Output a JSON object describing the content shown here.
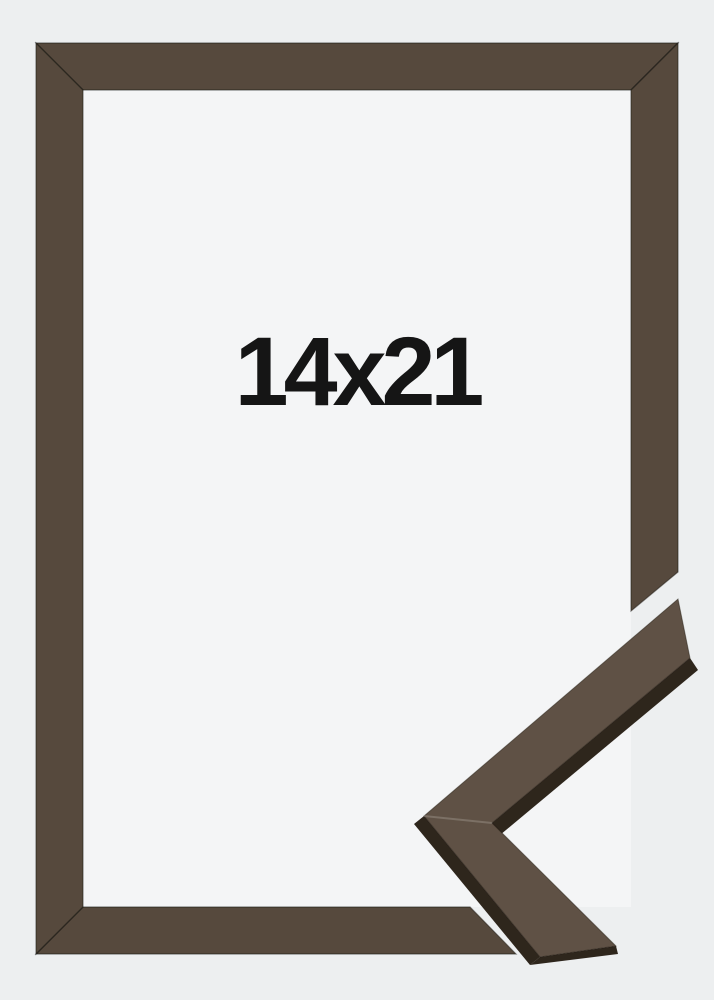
{
  "product_photo": {
    "size_label": "14x21",
    "colors": {
      "background": "#edeff0",
      "opening": "#f4f5f6",
      "wood_base": "#564a3d",
      "wood_detail": "#5e5144",
      "wood_side_dark": "#2e251c",
      "wood_edge_line": "#241d15",
      "label_text": "#151515"
    }
  }
}
